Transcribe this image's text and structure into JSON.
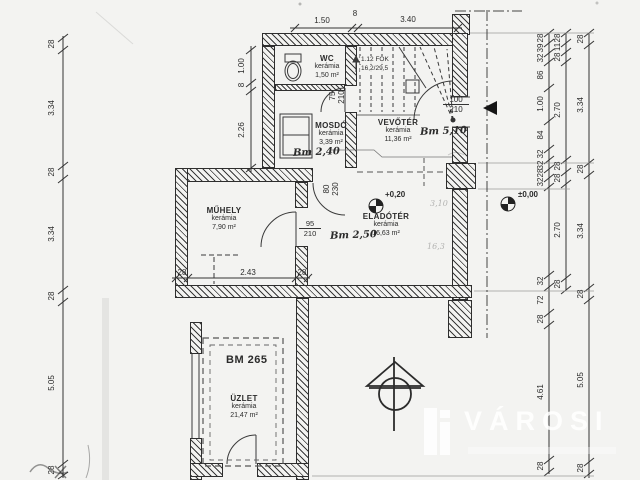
{
  "watermark": {
    "brand": "VÁROSI"
  },
  "rooms": {
    "wc": {
      "name": "WC",
      "material": "kerámia",
      "area": "1,50 m²"
    },
    "mosdo": {
      "name": "MOSDÓ",
      "material": "kerámia",
      "area": "3,39 m²",
      "height_note": "Bm 2,40"
    },
    "vevoter": {
      "name": "VEVŐTÉR",
      "material": "kerámia",
      "area": "11,36 m²",
      "height_note": "Bm 5,10"
    },
    "eladoter": {
      "name": "ELADÓTÉR",
      "material": "kerámia",
      "area": "16,63 m²",
      "height_note": "Bm 2,50",
      "level": "+0,20"
    },
    "muhely": {
      "name": "MŰHELY",
      "material": "kerámia",
      "area": "7,90 m²"
    },
    "uzlet": {
      "name": "ÜZLET",
      "material": "kerámia",
      "area": "21,47 m²",
      "code": "BM 265"
    }
  },
  "stair": {
    "steps": "1.12 FOK",
    "riser_tread": "16,2/29,5"
  },
  "doors": {
    "wc": {
      "w": "75",
      "h": "210"
    },
    "mosdo": {
      "w": "80",
      "h": "230"
    },
    "muhely": {
      "w": "95",
      "h": "210"
    },
    "entrance": {
      "w": "100",
      "h": "210"
    }
  },
  "levels": {
    "ground": "±0,00",
    "shop": "+0,20"
  },
  "notes": {
    "pencil_a": "3,10",
    "pencil_b": "16,3"
  },
  "dims": {
    "top": [
      "1.50",
      "8",
      "3.40"
    ],
    "left_inner": [
      "1.00",
      "8",
      "2.26"
    ],
    "left_outer": [
      "28",
      "3.34",
      "28",
      "3.34",
      "28",
      "5.05",
      "28"
    ],
    "muhely": [
      "28",
      "2.43",
      "28"
    ],
    "right_inner": [
      "28",
      "39",
      "32",
      "86",
      "1.00",
      "84",
      "32",
      "32",
      "28",
      "32",
      "32",
      "72",
      "28",
      "4.61",
      "28"
    ],
    "right_middle": [
      "28",
      "11",
      "28",
      "2.70",
      "28",
      "28",
      "2.70",
      "28"
    ],
    "right_outer": [
      "28",
      "3.34",
      "28",
      "3.34",
      "28",
      "5.05",
      "28"
    ]
  }
}
